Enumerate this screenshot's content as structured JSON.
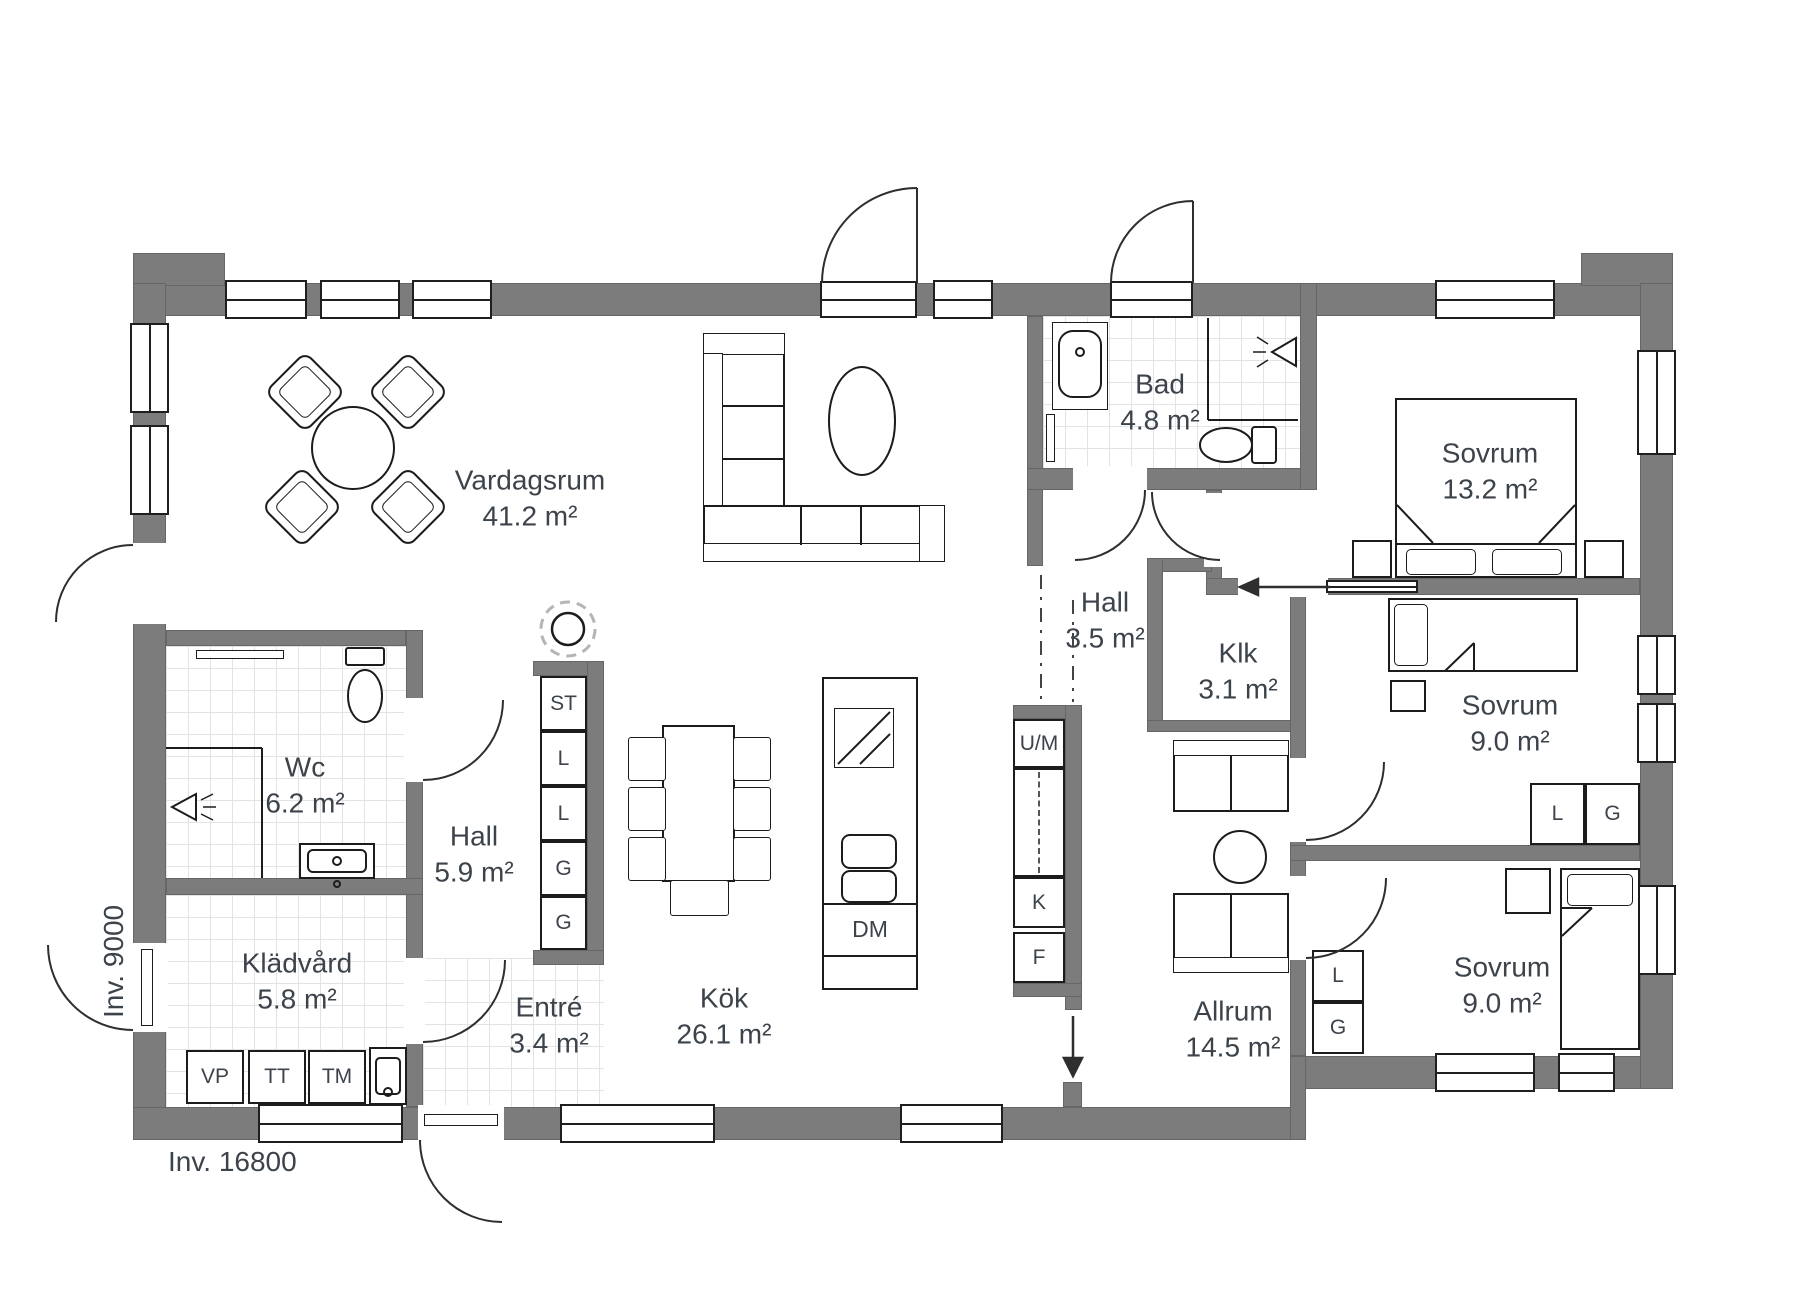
{
  "dimensions": {
    "width_label": "Inv. 16800",
    "depth_label": "Inv. 9000"
  },
  "rooms": [
    {
      "name": "Vardagsrum",
      "area": "41.2 m²"
    },
    {
      "name": "Kök",
      "area": "26.1 m²"
    },
    {
      "name": "Hall",
      "area": "5.9 m²"
    },
    {
      "name": "Wc",
      "area": "6.2 m²"
    },
    {
      "name": "Klädvård",
      "area": "5.8 m²"
    },
    {
      "name": "Entré",
      "area": "3.4 m²"
    },
    {
      "name": "Bad",
      "area": "4.8 m²"
    },
    {
      "name": "Hall",
      "area": "3.5 m²"
    },
    {
      "name": "Klk",
      "area": "3.1 m²"
    },
    {
      "name": "Sovrum",
      "area": "13.2 m²"
    },
    {
      "name": "Sovrum",
      "area": "9.0 m²"
    },
    {
      "name": "Sovrum",
      "area": "9.0 m²"
    },
    {
      "name": "Allrum",
      "area": "14.5 m²"
    }
  ],
  "closet_column": [
    "ST",
    "L",
    "L",
    "G",
    "G"
  ],
  "bedroom_mid_closets": [
    "L",
    "G"
  ],
  "bedroom_bottom_closets": [
    "L",
    "G"
  ],
  "appliances": {
    "um": "U/M",
    "k": "K",
    "f": "F",
    "dm": "DM",
    "vp": "VP",
    "tt": "TT",
    "tm": "TM"
  },
  "colors": {
    "wall": "#7c7c7c",
    "line": "#1c1c1c",
    "tile_line": "#e3e3e3",
    "text": "#3d434b"
  }
}
